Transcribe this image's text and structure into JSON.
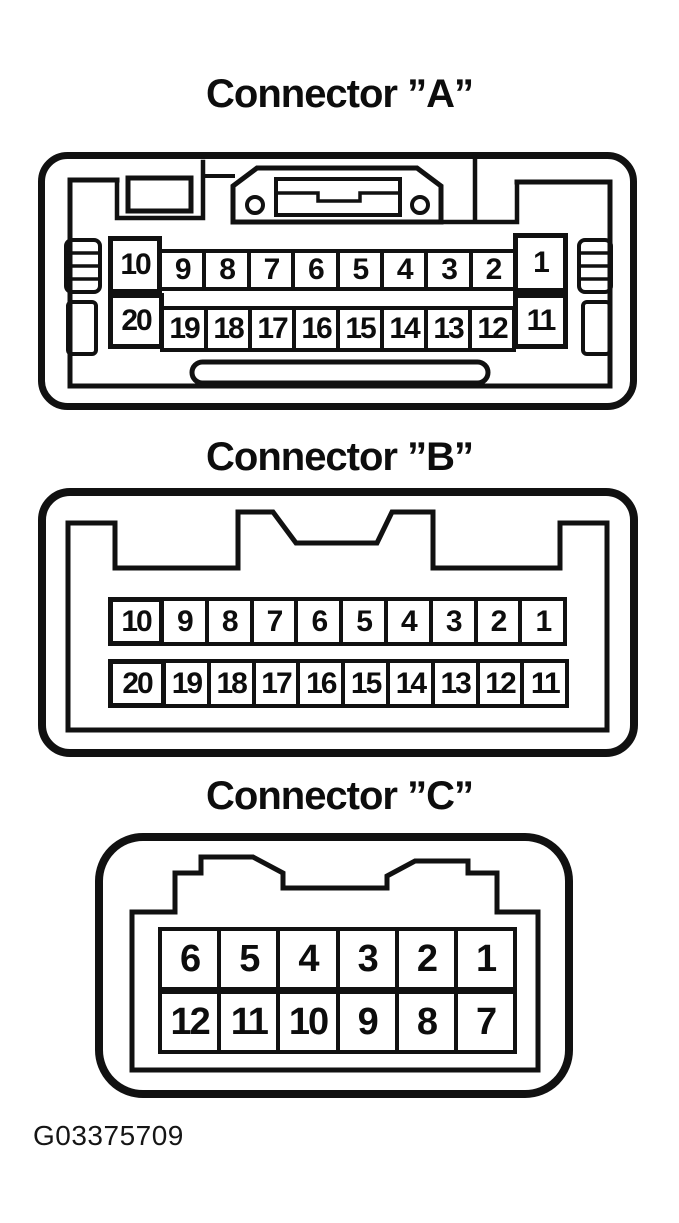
{
  "page": {
    "figure_id": "G03375709",
    "background": "#ffffff",
    "ink_color": "#111111"
  },
  "connectors": [
    {
      "id": "A",
      "title": "Connector ”A”",
      "pin_rows": [
        [
          "10",
          "9",
          "8",
          "7",
          "6",
          "5",
          "4",
          "3",
          "2",
          "1"
        ],
        [
          "20",
          "19",
          "18",
          "17",
          "16",
          "15",
          "14",
          "13",
          "12",
          "11"
        ]
      ]
    },
    {
      "id": "B",
      "title": "Connector ”B”",
      "pin_rows": [
        [
          "10",
          "9",
          "8",
          "7",
          "6",
          "5",
          "4",
          "3",
          "2",
          "1"
        ],
        [
          "20",
          "19",
          "18",
          "17",
          "16",
          "15",
          "14",
          "13",
          "12",
          "11"
        ]
      ]
    },
    {
      "id": "C",
      "title": "Connector ”C”",
      "pin_rows": [
        [
          "6",
          "5",
          "4",
          "3",
          "2",
          "1"
        ],
        [
          "12",
          "11",
          "10",
          "9",
          "8",
          "7"
        ]
      ]
    }
  ]
}
